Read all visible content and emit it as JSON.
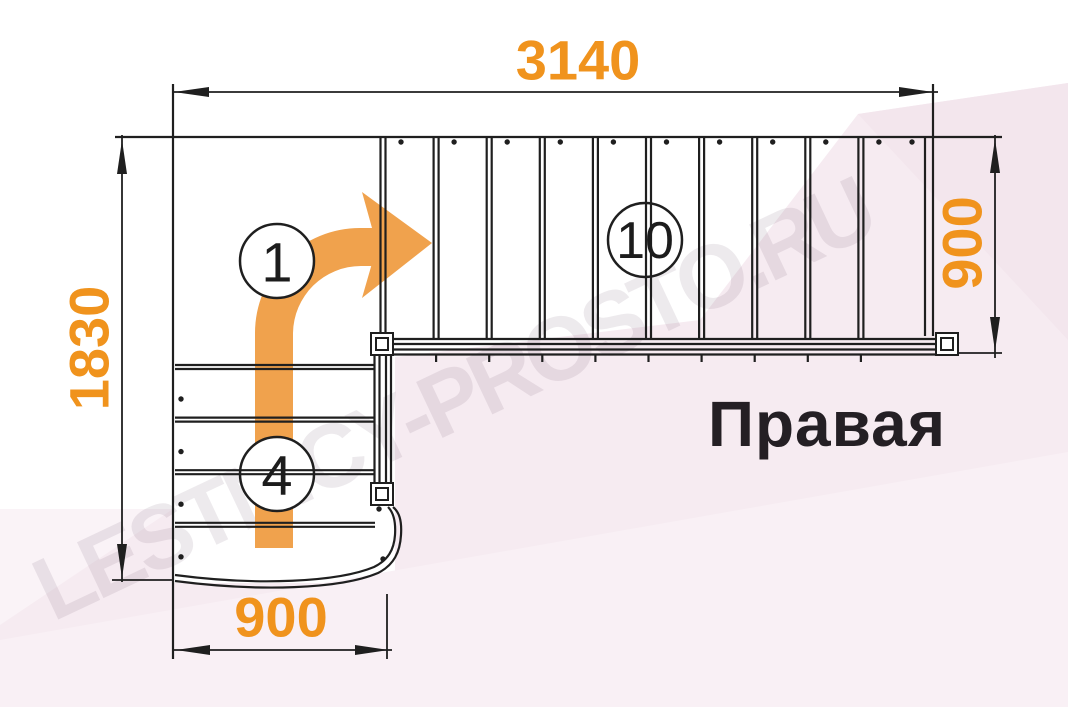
{
  "diagram": {
    "orientation_label": "Правая",
    "watermark_text": "LESTNICY-PROSTO.RU",
    "dimensions": {
      "top_length": "3140",
      "left_depth": "1830",
      "right_flight_width": "900",
      "bottom_flight_width": "900"
    },
    "step_markers": {
      "first_step": "1",
      "lower_flight_steps": "4",
      "upper_flight_steps": "10"
    },
    "stairs": {
      "upper_tread_count": 10,
      "lower_tread_count": 4
    },
    "colors": {
      "dimension_orange": "#F0931D",
      "arrow_orange": "#F0A24D",
      "line_black": "#1f1f1f",
      "bg_pink": "#f6ebf1",
      "bg_pink_light": "#f9f0f5",
      "bg_pink_mid": "#f3e6ed",
      "bg_pink_pale": "#faf3f7"
    }
  }
}
